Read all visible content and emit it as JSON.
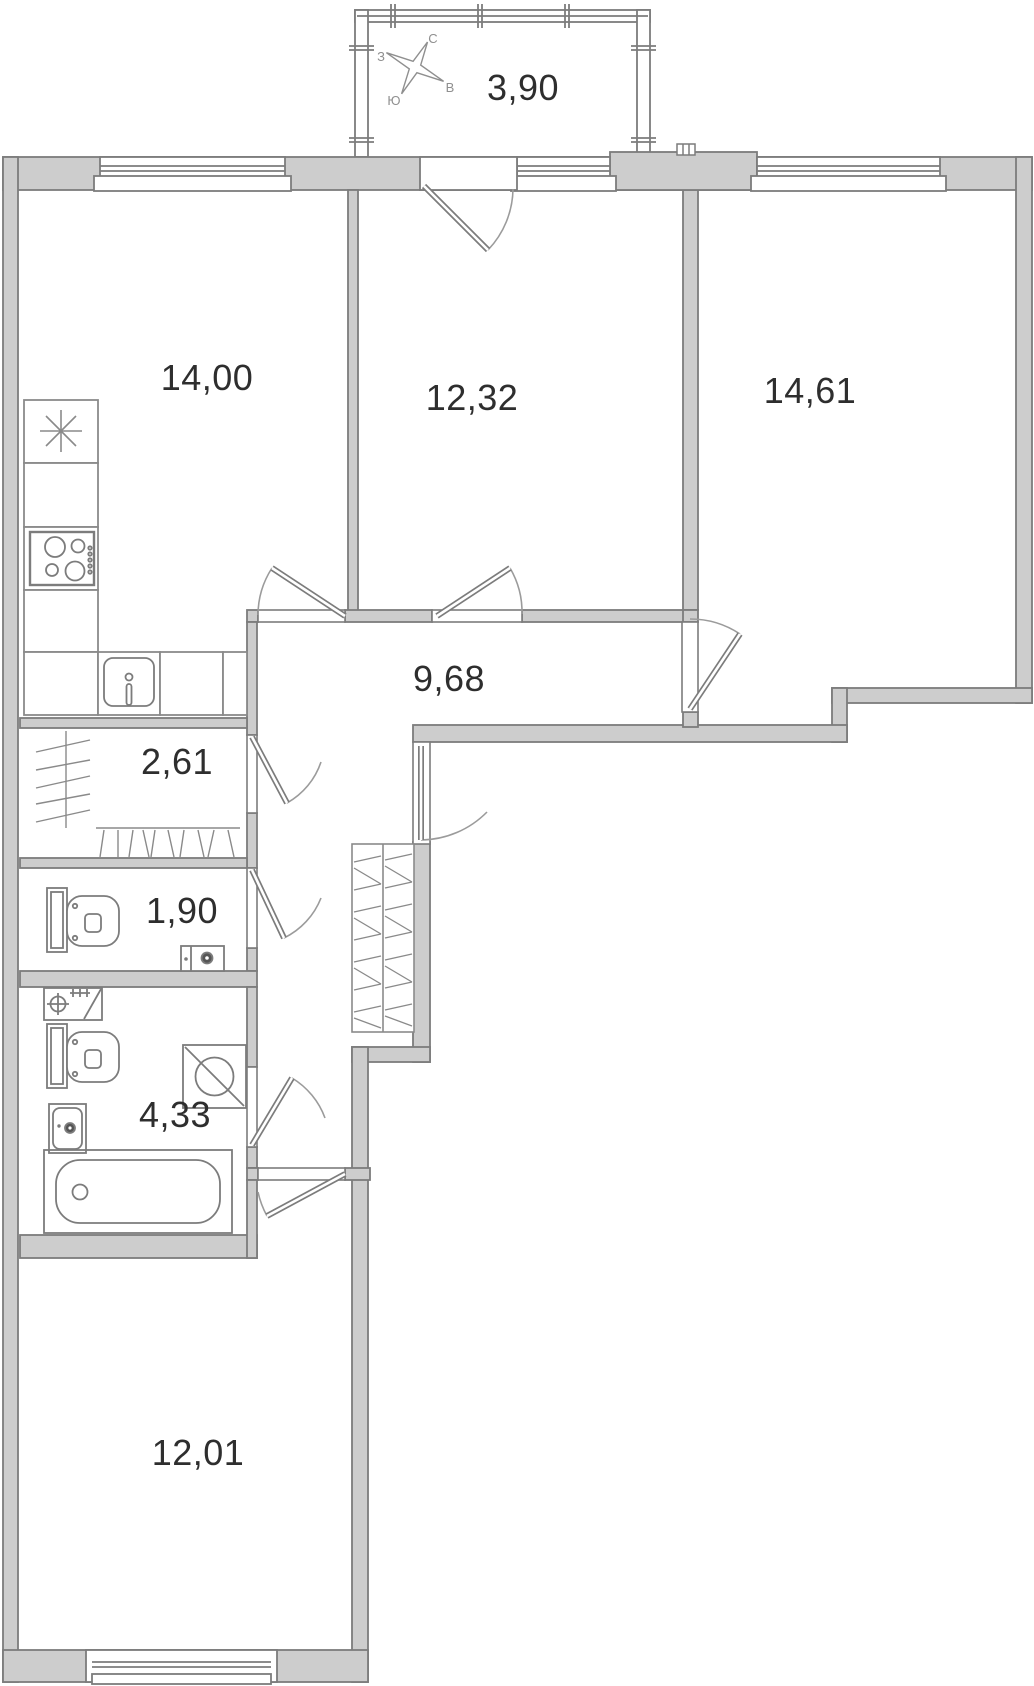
{
  "plan": {
    "title": "apartment-floor-plan",
    "compass": {
      "north": "С",
      "south": "Ю",
      "west": "З",
      "east": "В"
    },
    "rooms": [
      {
        "id": "balcony",
        "area": "3,90"
      },
      {
        "id": "kitchen",
        "area": "14,00"
      },
      {
        "id": "room-1232",
        "area": "12,32"
      },
      {
        "id": "room-1461",
        "area": "14,61"
      },
      {
        "id": "hallway",
        "area": "9,68"
      },
      {
        "id": "closet",
        "area": "2,61"
      },
      {
        "id": "wc",
        "area": "1,90"
      },
      {
        "id": "bathroom",
        "area": "4,33"
      },
      {
        "id": "room-1201",
        "area": "12,01"
      }
    ],
    "colors": {
      "wall_fill": "#cdcdcd",
      "wall_stroke": "#7c7c7c",
      "fixture_stroke": "#7c7c7c",
      "door_arc": "#9b9b9b",
      "label_text": "#2e2e2e",
      "compass_text": "#8f8f8f"
    }
  }
}
